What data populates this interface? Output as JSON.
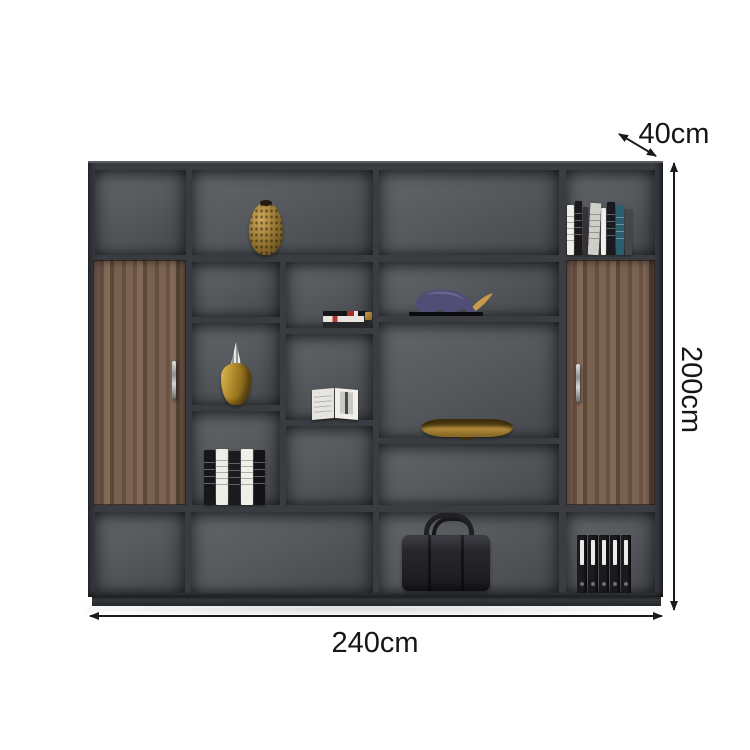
{
  "page": {
    "type": "furniture product dimension diagram",
    "background": "#ffffff"
  },
  "product": {
    "name": "dark gray office bookcase with walnut cabinet doors",
    "frame_color": "#35383c",
    "interior_color": "#56595d",
    "wood_color": "#72594a",
    "plinth_color": "#2c2f33",
    "gold_accent": "#a8862f"
  },
  "dimensions": {
    "width": {
      "label": "240cm"
    },
    "height": {
      "label": "200cm"
    },
    "depth": {
      "label": "40cm"
    },
    "annotation_color": "#1a1a1a"
  },
  "decor_items": [
    {
      "name": "bronze-mesh-vase",
      "location": "top row second compartment"
    },
    {
      "name": "book-row",
      "location": "top right compartment"
    },
    {
      "name": "purple-rhino-figurine",
      "location": "center compartment",
      "horn_color": "#c89a4a"
    },
    {
      "name": "flat-book-stack",
      "location": "middle column upper shelf"
    },
    {
      "name": "gold-decanter-silver-top",
      "location": "second column middle shelf"
    },
    {
      "name": "open-display-book",
      "location": "middle column center shelf"
    },
    {
      "name": "black-white-book-set",
      "location": "second column lower shelf"
    },
    {
      "name": "gold-display-bowl",
      "location": "center wide shelf"
    },
    {
      "name": "black-leather-briefcase",
      "location": "bottom row center-right"
    },
    {
      "name": "ring-binders",
      "location": "bottom right compartment",
      "count": 5
    }
  ]
}
